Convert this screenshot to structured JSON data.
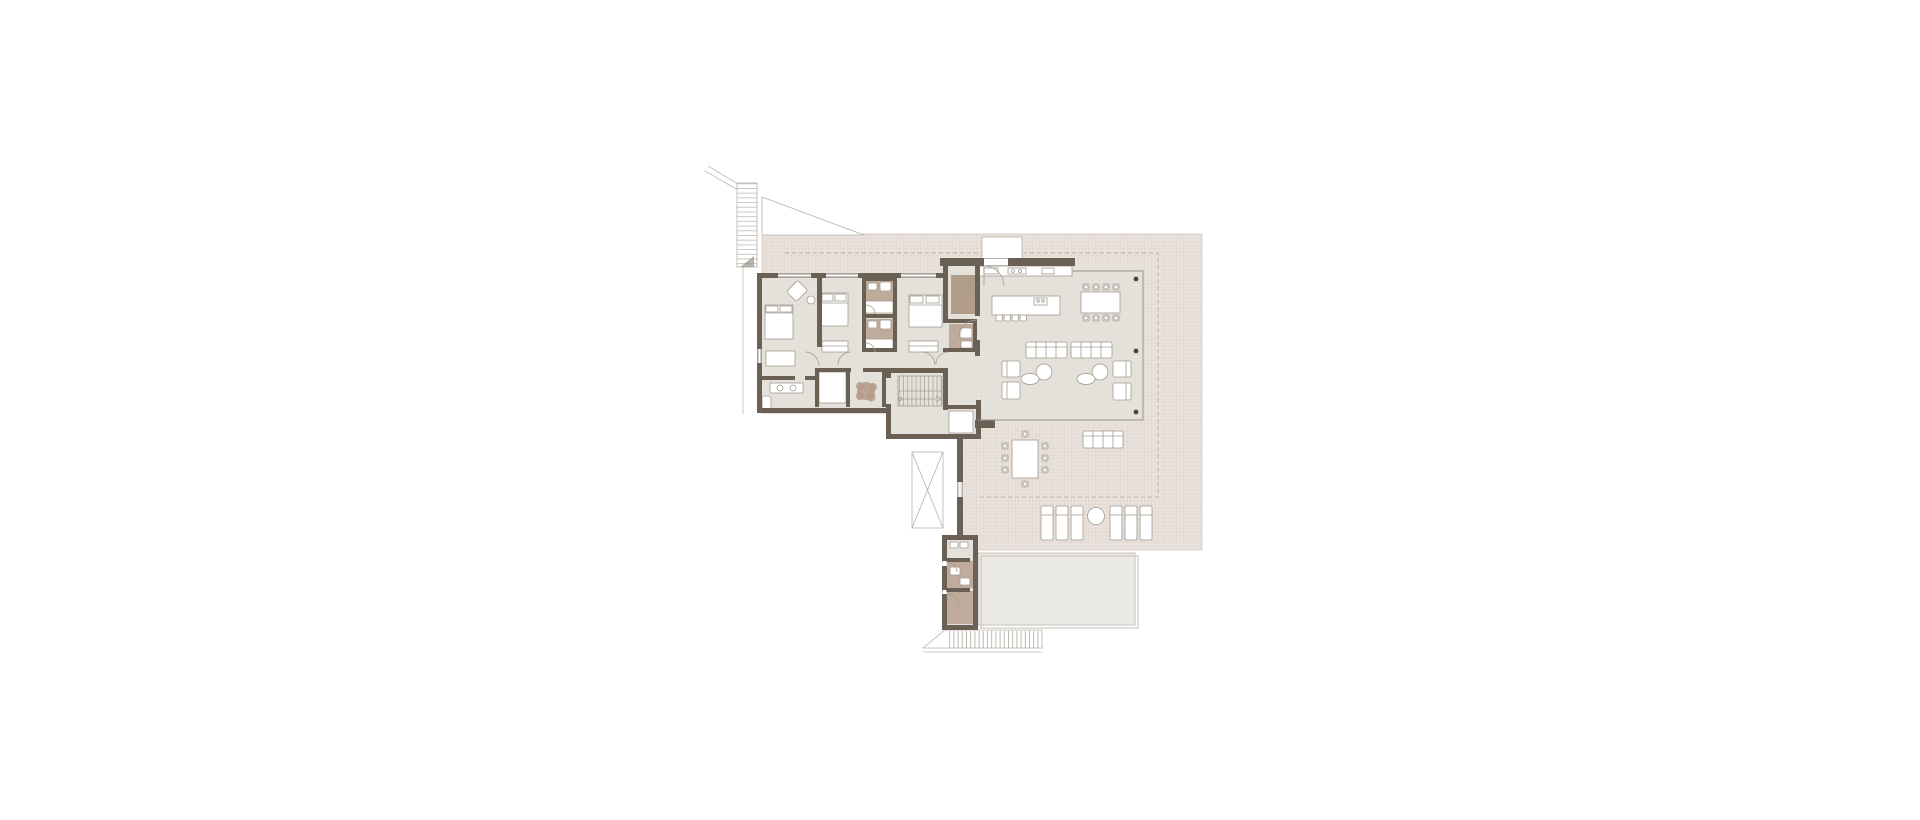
{
  "meta": {
    "title": "Architectural floor plan — upper level of a villa",
    "drawing_type": "floor-plan",
    "visible_text": "none"
  },
  "colors": {
    "wall": "#6a6054",
    "floor": "#e4e1db",
    "wood": "#bfab99",
    "wood2": "#b29c8a",
    "terr": "#eae2dc",
    "terrline": "#d7ccc4",
    "pool": "#eae9e3",
    "poolline": "#c6c1b8",
    "outline": "#b7b1a8",
    "furn": "#a29c91",
    "glass": "#98928a",
    "col": "#4c463e",
    "site": "#c3bcb3",
    "dash": "#b3aba1",
    "plant": "#b49a85"
  },
  "rooms": [
    {
      "name": "bedroom-1",
      "furniture": [
        "double-bed",
        "corner-armchair",
        "dresser"
      ]
    },
    {
      "name": "bedroom-2",
      "furniture": [
        "double-bed",
        "wardrobe"
      ]
    },
    {
      "name": "bedroom-3",
      "furniture": [
        "double-bed",
        "wardrobe"
      ]
    },
    {
      "name": "ensuite-bathroom-a",
      "furniture": [
        "washbasin",
        "wc",
        "bathtub"
      ]
    },
    {
      "name": "ensuite-bathroom-b",
      "furniture": [
        "washbasin",
        "wc",
        "bathtub"
      ]
    },
    {
      "name": "family-bathroom",
      "furniture": [
        "double-vanity",
        "wc"
      ]
    },
    {
      "name": "dressing-room",
      "furniture": []
    },
    {
      "name": "hallway",
      "furniture": [
        "plant"
      ]
    },
    {
      "name": "guest-wc",
      "furniture": [
        "wc",
        "washbasin"
      ]
    },
    {
      "name": "entry-vestibule",
      "furniture": []
    },
    {
      "name": "stair-hall",
      "furniture": [
        "staircase",
        "elevator"
      ]
    },
    {
      "name": "kitchen",
      "furniture": [
        "wall-counter",
        "sink",
        "cooktop",
        "island",
        "bar-stools"
      ]
    },
    {
      "name": "dining-area",
      "furniture": [
        "dining-table",
        "eight-chairs"
      ]
    },
    {
      "name": "living-area",
      "furniture": [
        "sofa",
        "sofa",
        "armchairs",
        "coffee-tables",
        "chaise"
      ]
    },
    {
      "name": "utility-room-1",
      "furniture": [
        "washbasin-row"
      ]
    },
    {
      "name": "utility-room-2",
      "furniture": [
        "wc",
        "washbasin"
      ]
    },
    {
      "name": "utility-room-3",
      "furniture": []
    },
    {
      "name": "roof-terrace",
      "furniture": [
        "outdoor-dining-table",
        "outdoor-sofa",
        "six-sun-loungers",
        "side-table"
      ]
    },
    {
      "name": "pool",
      "furniture": []
    },
    {
      "name": "skylight",
      "furniture": []
    },
    {
      "name": "exterior-stair-northwest",
      "furniture": []
    },
    {
      "name": "exterior-stair-south",
      "furniture": []
    }
  ]
}
